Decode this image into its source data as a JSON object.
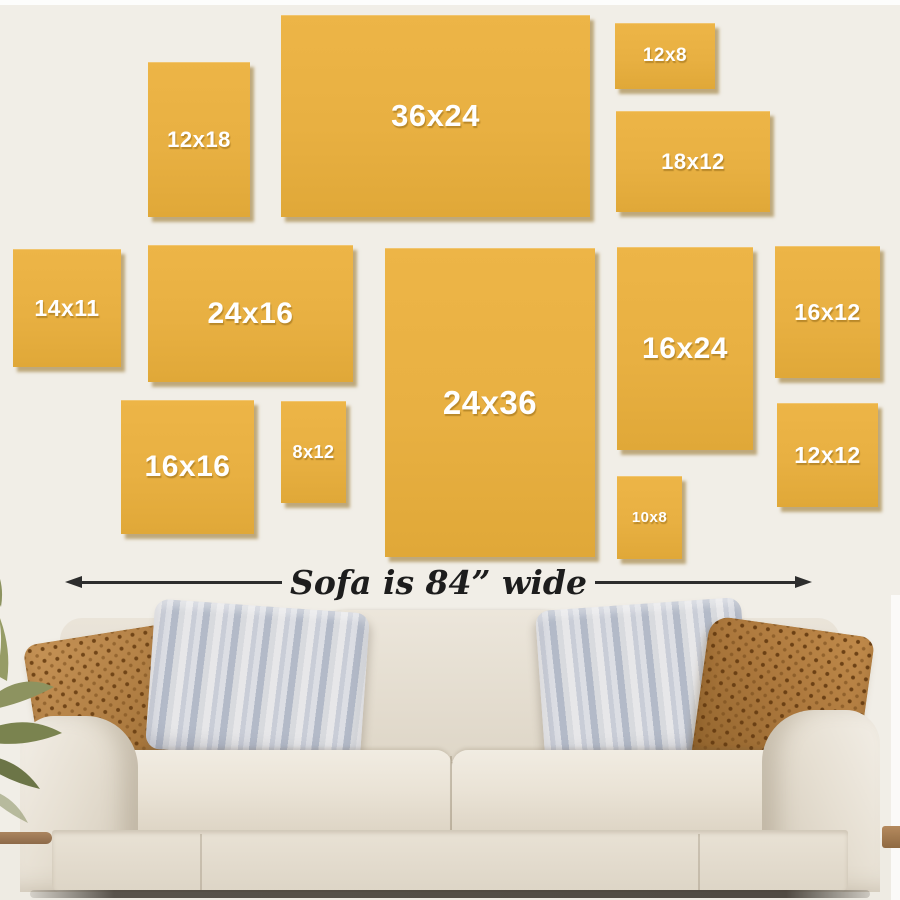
{
  "page": {
    "background_color": "#f1eee7",
    "canvas_color": "#e8b042",
    "label_color": "#ffffff",
    "arrow_color": "#2d2d2d"
  },
  "frames": [
    {
      "label": "12x18"
    },
    {
      "label": "36x24"
    },
    {
      "label": "12x8"
    },
    {
      "label": "18x12"
    },
    {
      "label": "14x11"
    },
    {
      "label": "24x16"
    },
    {
      "label": "24x36"
    },
    {
      "label": "16x24"
    },
    {
      "label": "16x12"
    },
    {
      "label": "16x16"
    },
    {
      "label": "8x12"
    },
    {
      "label": "10x8"
    },
    {
      "label": "12x12"
    }
  ],
  "dimension_note": {
    "text": "Sofa is 84” wide"
  }
}
